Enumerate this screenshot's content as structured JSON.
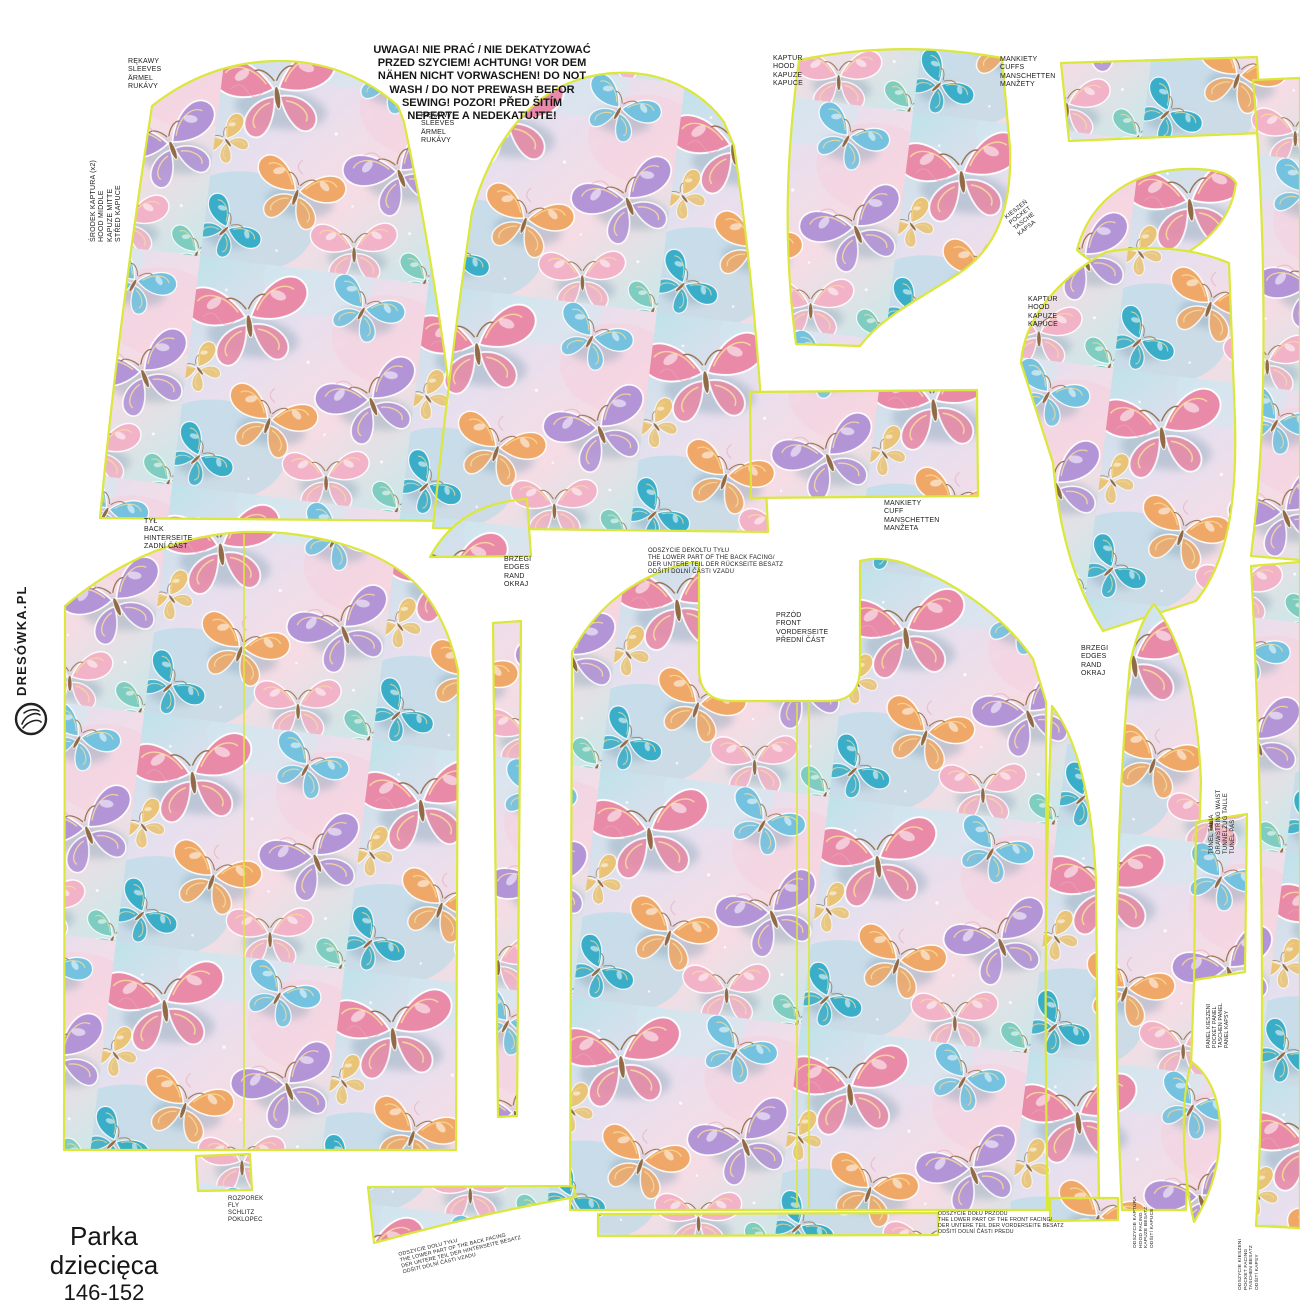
{
  "product": {
    "name": "Parka dziecięca",
    "size": "146-152"
  },
  "brand": {
    "name": "DRESÓWKA.PL"
  },
  "warning_note": "UWAGA! NIE PRAĆ / NIE DEKATYZOWAĆ\nPRZED SZYCIEM! ACHTUNG! VOR DEM\nNÄHEN NICHT VORWASCHEN! DO NOT\nWASH / DO NOT PREWASH BEFOR\nSEWING! POZOR! PŘED ŠITÍM\nNEPERTE A NEDEKATUJTE!",
  "labels": {
    "hood_middle": "ŚRODEK KAPTURA (x2)\nHOOD MIDDLE\nKAPUZE MITTE\nSTŘED KAPUCE",
    "sleeves_left": "RĘKAWY\nSLEEVES\nÄRMEL\nRUKÁVY",
    "sleeves_right": "RĘKAWY\nSLEEVES\nÄRMEL\nRUKÁVY",
    "hood_left": "KAPTUR\nHOOD\nKAPUZE\nKAPUCE",
    "cuffs_top": "MANKIETY\nCUFFS\nMANSCHETTEN\nMANŽETY",
    "pocket_top": "KIESZEŃ\nPOCKET\nTASCHE\nKAPSA",
    "hood_right": "KAPTUR\nHOOD\nKAPUZE\nKAPUCE",
    "cuffs_center": "MANKIETY\nCUFF\nMANSCHETTEN\nMANŽETA",
    "back": "TYŁ\nBACK\nHINTERSEITE\nZADNÍ ČÁST",
    "edges_front": "BRZEGI\nEDGES\nRAND\nOKRAJ",
    "back_neck_facing": "ODSZYCIE DEKOLTU TYŁU\nTHE LOWER PART OF THE BACK FACING/\nDER UNTERE TEIL DER RÜCKSEITE BESATZ\nODŠITÍ DOLNÍ ČÁSTI VZADU",
    "front": "PRZÓD\nFRONT\nVORDERSEITE\nPŘEDNÍ ČÁST",
    "edges_side": "BRZEGI\nEDGES\nRAND\nOKRAJ",
    "waist_tunnel": "TUNEL TALIA\nDRAWSTRING WAIST\nTUNNELZUG TAILLE\nTUNEL PAS",
    "pocket_panel": "PANEL KIESZENI\nPOCKET PANEL\nTASCHEN PANEL\nPANEL KAPSY",
    "fly": "ROZPOREK\nFLY\nSCHLITZ\nPOKLOPEC",
    "back_hem_facing": "ODSZYCIE DOŁU TYŁU\nTHE LOWER PART OF THE BACK FACING\nDER UNTERE TEIL DER HINTERSEITE BESATZ\nODŠITÍ DOLNÍ ČÁSTI VZADU",
    "front_hem_facing": "ODSZYCIE DOŁU PRZODU\nTHE LOWER PART OF THE FRONT FACING/\nDER UNTERE TEIL DER VORDERSEITE BESATZ\nODŠITÍ DOLNÍ ČÁSTI PŘEDU",
    "hood_facing": "ODSZYCIE KAPTURA\nHOOD FACING\nKAPUZE BESATZ\nODŠITÍ KAPUCE",
    "pocket_facing": "ODSZYCIE KIESZENI\nPOCKET FACING\nTASCHEN BESATZ\nODŠITÍ KAPSY"
  },
  "colors": {
    "outline": "#dbe73a",
    "fabric_base_blue": "#bfe2ea",
    "fabric_base_pink": "#f6dce4",
    "butterfly_pink": "#e88aa8",
    "butterfly_blue": "#74c2e0",
    "butterfly_purple": "#b394d6",
    "butterfly_orange": "#f0a868",
    "butterfly_teal": "#3aaec9",
    "butterfly_gold": "#e9c478"
  }
}
